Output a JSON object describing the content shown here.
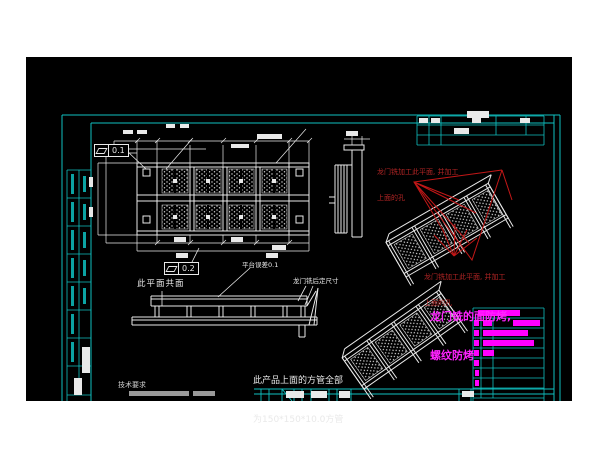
{
  "window": {
    "background": "#ffffff",
    "canvas_color": "#000000"
  },
  "colors": {
    "frame_cyan": "#0fc0c0",
    "line_white": "#e9e9e9",
    "annotation_red": "#c21717",
    "highlight_magenta": "#ff00ff"
  },
  "fcf": {
    "top_symbol": "flatness",
    "top_value": "0.1",
    "bottom_symbol": "flatness",
    "bottom_value": "0.2"
  },
  "labels": {
    "coplanar": "此平面共面",
    "platform_tolerance": "平台误差0.1",
    "gantry_mill_size": "龙门铣后定尺寸",
    "tech_requirements": "技术要求",
    "tube_note_line1": "此产品上面的方管全部",
    "tube_note_line2": "为150*150*10.0方管"
  },
  "red_notes": {
    "top_line1": "龙门铣加工此平面, 并加工",
    "top_line2": "上面的孔",
    "bottom_line1": "龙门铣加工此平面, 并加工",
    "bottom_line2": "上面的孔"
  },
  "magenta_note": {
    "line1": "龙门铣的面防烤,",
    "line2": "螺纹防烤"
  }
}
